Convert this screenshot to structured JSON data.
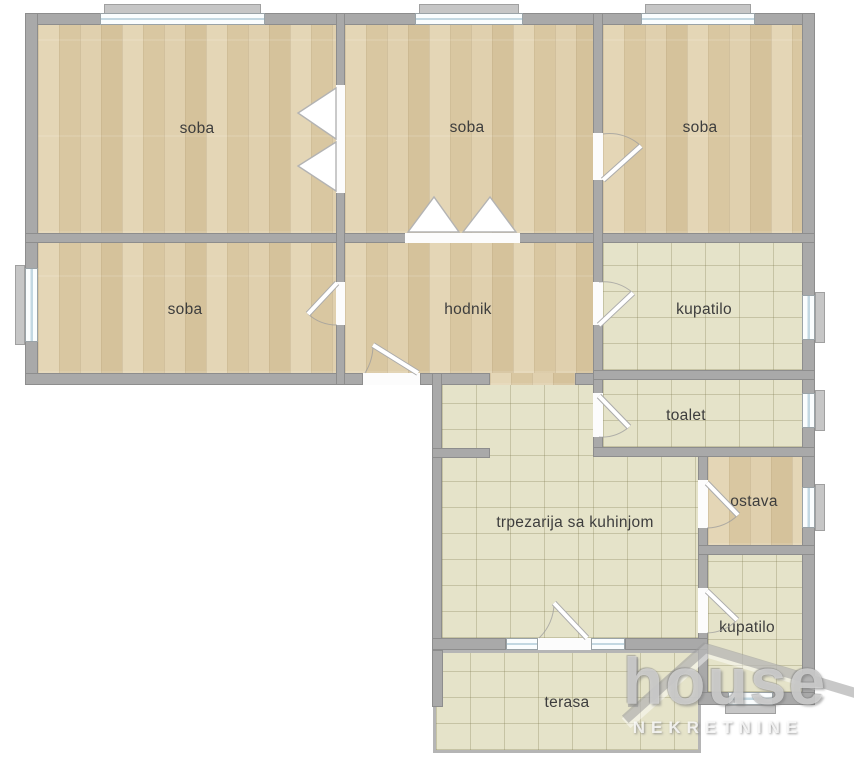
{
  "rooms": [
    {
      "id": "soba-1",
      "label": "soba",
      "floor": "wood"
    },
    {
      "id": "soba-2",
      "label": "soba",
      "floor": "wood"
    },
    {
      "id": "soba-3",
      "label": "soba",
      "floor": "wood"
    },
    {
      "id": "soba-4",
      "label": "soba",
      "floor": "wood"
    },
    {
      "id": "hodnik",
      "label": "hodnik",
      "floor": "wood"
    },
    {
      "id": "kupatilo-1",
      "label": "kupatilo",
      "floor": "tile"
    },
    {
      "id": "toalet",
      "label": "toalet",
      "floor": "tile"
    },
    {
      "id": "trpezarija",
      "label": "trpezarija sa kuhinjom",
      "floor": "tile"
    },
    {
      "id": "ostava",
      "label": "ostava",
      "floor": "wood"
    },
    {
      "id": "kupatilo-2",
      "label": "kupatilo",
      "floor": "tile"
    },
    {
      "id": "terasa",
      "label": "terasa",
      "floor": "tile"
    }
  ],
  "watermark": {
    "brand": "house",
    "subtitle": "NEKRETNINE"
  },
  "colors": {
    "wall": "#a9a9a9",
    "wood_floor": "#decdaa",
    "tile_floor": "#e5e3c9",
    "label_text": "#3d3d3d",
    "window_glass": "#fafdfe",
    "window_tint": "#c3d8e2"
  }
}
